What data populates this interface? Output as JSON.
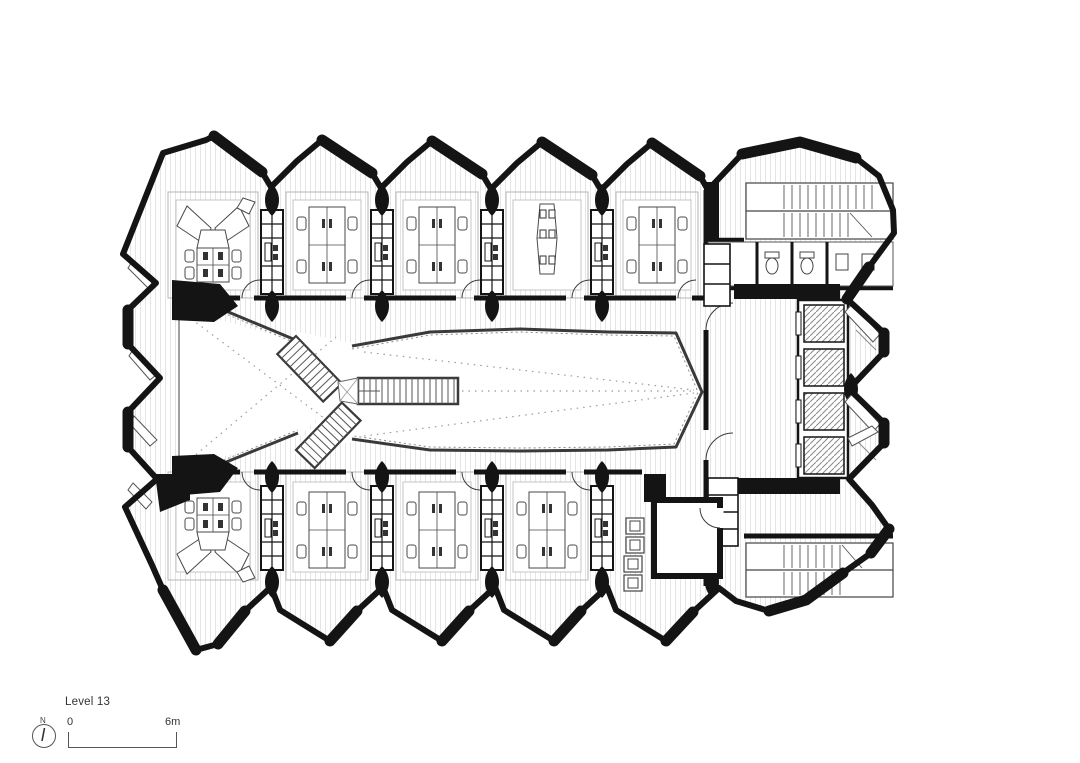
{
  "title_block": {
    "floor_label": "Level 13",
    "north_indicator": {
      "letter": "N"
    },
    "scale_bar": {
      "start_label": "0",
      "end_label": "6m"
    }
  },
  "plan": {
    "kind": "architectural floor plan, black ink on white",
    "ink_color": "#141414",
    "floor_board_color": "#d9d9d9",
    "railing_color": "#3a3a3a",
    "dashed_guide_color": "#9a9a9a",
    "top_wing_bays": [
      {
        "id": "top-1",
        "furniture": "radial-y-desk-cluster",
        "seats": 6
      },
      {
        "id": "top-2",
        "furniture": "quad-workstation-cluster",
        "seats": 4
      },
      {
        "id": "top-3",
        "furniture": "quad-workstation-cluster",
        "seats": 4
      },
      {
        "id": "top-4",
        "furniture": "six-seat-meeting-table",
        "seats": 6
      },
      {
        "id": "top-5",
        "furniture": "quad-workstation-cluster",
        "seats": 4
      }
    ],
    "bottom_wing_bays": [
      {
        "id": "bottom-1",
        "furniture": "radial-y-desk-cluster",
        "seats": 6
      },
      {
        "id": "bottom-2",
        "furniture": "quad-workstation-cluster",
        "seats": 4
      },
      {
        "id": "bottom-3",
        "furniture": "quad-workstation-cluster",
        "seats": 4
      },
      {
        "id": "bottom-4",
        "furniture": "quad-workstation-cluster",
        "seats": 4
      },
      {
        "id": "bottom-5",
        "furniture": "kitchenette-and-meeting-room",
        "seats": 0
      }
    ],
    "atrium": {
      "features": [
        "open void with dashed sightlines",
        "y-shaped stair junction",
        "long straight stair run"
      ]
    },
    "service_core": {
      "elements": [
        "upper switchback stair",
        "wc-room with fixtures",
        "elevator bank of 4 cars",
        "elevator lobby",
        "service shafts",
        "lower switchback stair"
      ]
    },
    "facade": {
      "top_edge": "5 sawtooth gable bays",
      "bottom_edge": "5 sawtooth bays pointing down",
      "left_edge": "2 triangular notches",
      "right_edge": "2 triangular teeth"
    }
  }
}
